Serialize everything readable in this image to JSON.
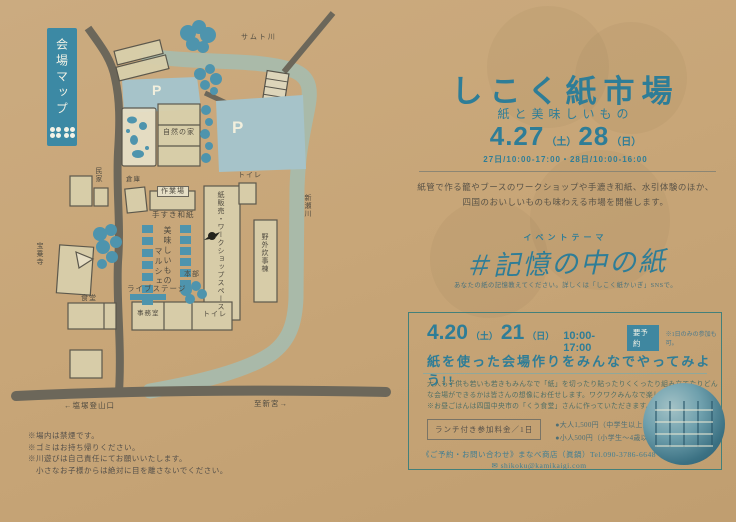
{
  "palette": {
    "paper": "#c8a678",
    "teal": "#2e7d97",
    "map_blue": "#4e94ad",
    "river": "#a8bbac",
    "road": "#6c675a",
    "parking": "#a6c3c9"
  },
  "map": {
    "banner_title": "会場マップ",
    "labels": {
      "samuto_river": "サムト川",
      "parking_p": "P",
      "nature_house": "自然の家",
      "minka": "民家",
      "souko": "倉庫",
      "sagyoba": "作業場",
      "tesuki_washi": "手すき和紙",
      "oishii_mono": "美味しいもの",
      "marche": "マルシェ",
      "kami_hanbai": "紙販売・ワークショップスペース",
      "honbu": "本部",
      "live_stage": "ライブステージ",
      "yagai_suiji": "野外炊事棟",
      "toilet_top": "トイレ",
      "toilet_bottom": "トイレ",
      "shinse_river": "新瀬川",
      "temple": "宝乗寺",
      "shokudo": "食堂",
      "jimushitsu": "事務室",
      "road_left": "←塩塚登山口",
      "road_right": "至新宮→"
    },
    "notes": [
      "※場内は禁煙です。",
      "※ゴミはお持ち帰りください。",
      "※川遊びは自己責任にてお願いいたします。",
      "　小さなお子様からは絶対に目を離さないでください。"
    ]
  },
  "main": {
    "title": "しこく紙市場",
    "subtitle": "紙と美味しいもの",
    "date": {
      "d1": "4.27",
      "w1": "（土）",
      "d2": "28",
      "w2": "（日）"
    },
    "hours": "27日/10:00-17:00・28日/10:00-16:00",
    "description_line1": "紙管で作る籠やブースのワークショップや手漉き和紙、水引体験のほか、",
    "description_line2": "四国のおいしいものも味わえる市場を開催します。",
    "theme_label": "イベントテーマ",
    "theme": "＃記憶の中の紙",
    "theme_note": "あなたの紙の記憶教えてください。詳しくは「しこく紙かいぎ」SNSで。",
    "workshop": {
      "date_d1": "4.20",
      "date_w1": "（土）",
      "date_d2": "21",
      "date_w2": "（日）",
      "time": "10:00-17:00",
      "badge": "要予約",
      "badge_note": "※1日のみの参加も可。",
      "headline": "紙を使った会場作りをみんなでやってみよう!!",
      "body_line1": "大人も子供も若いも若きもみんなで「紙」を切ったり貼ったりくくったり組み立てたりどん",
      "body_line2": "な会場ができるかは皆さんの想像にお任せします。ワクワクみんなで楽しもう。",
      "body_line3": "※お昼ごはんは四国中央市の「くう食堂」さんに作っていただきます。",
      "price_label": "ランチ付き参加料金／1日",
      "price_adult": "●大人1,500円（中学生以上）",
      "price_child": "●小人500円（小学生～4歳以上）幼児無料",
      "contact": "《ご予約・お問い合わせ》まなべ商店（眞鍋）Tel.090-3786-6648",
      "email_icon": "✉",
      "email": "shikoku@kamikaigi.com"
    }
  }
}
